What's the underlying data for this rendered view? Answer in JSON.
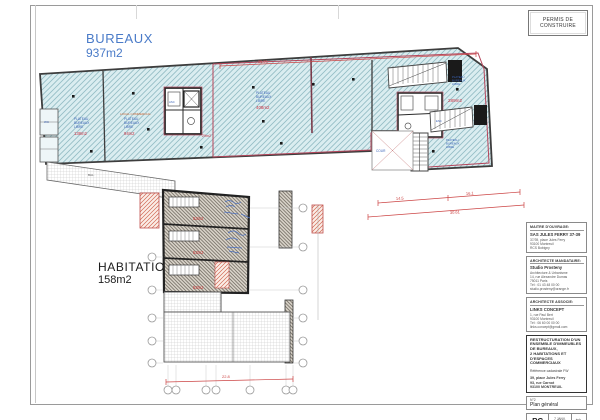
{
  "permit_box": {
    "line1": "PERMIS DE",
    "line2": "CONSTRUIRE"
  },
  "zones": {
    "bureaux_title": "BUREAUX",
    "bureaux_area": "937m2",
    "habitation_title": "HABITATION",
    "habitation_area": "158m2"
  },
  "plan_labels": {
    "room1": {
      "l1": "PLATEAU",
      "l2": "BUREAUX",
      "l3": "LIBRE",
      "area": "138m2"
    },
    "room2": {
      "heading": "LOCAL COMMERCIAL",
      "l1": "PLATEAU",
      "l2": "BUREAUX",
      "l3": "LIBRE",
      "area": "94m2"
    },
    "room3": {
      "l1": "PLATEAU",
      "l2": "BUREAUX",
      "l3": "LIBRE",
      "area": "408m2"
    },
    "room4": {
      "l1": "PLATEAU",
      "l2": "BUREAUX",
      "l3": "LIBRE",
      "area": "289m2"
    },
    "room5": {
      "l1": "PLATEAU",
      "l2": "BUREAUX",
      "l3": "LIBRE"
    },
    "core_area": "29m2",
    "cour": "COUR",
    "asc": "ASC",
    "esc": "ESC",
    "balcony": "BAL.",
    "wc": "WC",
    "hab_rooms": [
      "53m2",
      "53m2",
      "53m2"
    ]
  },
  "dimensions": {
    "top": "35.91",
    "mid1": "14.5",
    "mid2": "16.1",
    "mid3": "30.61",
    "bottom": "22.8"
  },
  "titleblock": {
    "owner": {
      "heading": "MAITRE D'OUVRAGE:",
      "name": "SAS JULES FERRY 37-39",
      "lines": [
        "37/39, place Jules Ferry",
        "93100 Montreuil",
        "RCS Bobigny"
      ]
    },
    "architect": {
      "heading": "ARCHITECTE MANDATAIRE:",
      "name": "Studio Prosteny",
      "lines": [
        "Architecture & Urbanisme",
        "14, rue Alexandre Dumas",
        "75011 Paris",
        "Tél : 01 43 48 00 00",
        "studio.prosteny@orange.fr"
      ]
    },
    "associate": {
      "heading": "ARCHITECTE ASSOCIE:",
      "name": "LINKS CONCEPT",
      "lines": [
        "1, rue Paul Bert",
        "93100 Montreuil",
        "Tél : 06 60 00 00 00",
        "links.concept@gmail.com"
      ]
    },
    "project": {
      "lines": [
        "RESTRUCTURATION D'UN",
        "ENSEMBLE D'IMMEUBLES",
        "DE BUREAUX,",
        "2 HABITATIONS ET",
        "D'ESPACES COMMERCIAUX"
      ],
      "reference": "Référence cadastrale FW",
      "address": [
        "39, place Jules Ferry",
        "93, rue Carnot",
        "93100 MONTREUIL"
      ]
    },
    "doc": {
      "number": "N°2",
      "name": "Plan général"
    },
    "stamp": {
      "phase": "PC",
      "date_line1": "7 JANV.",
      "date_line2": "2019",
      "scale_label": "éch.",
      "scale": "1/100"
    }
  }
}
